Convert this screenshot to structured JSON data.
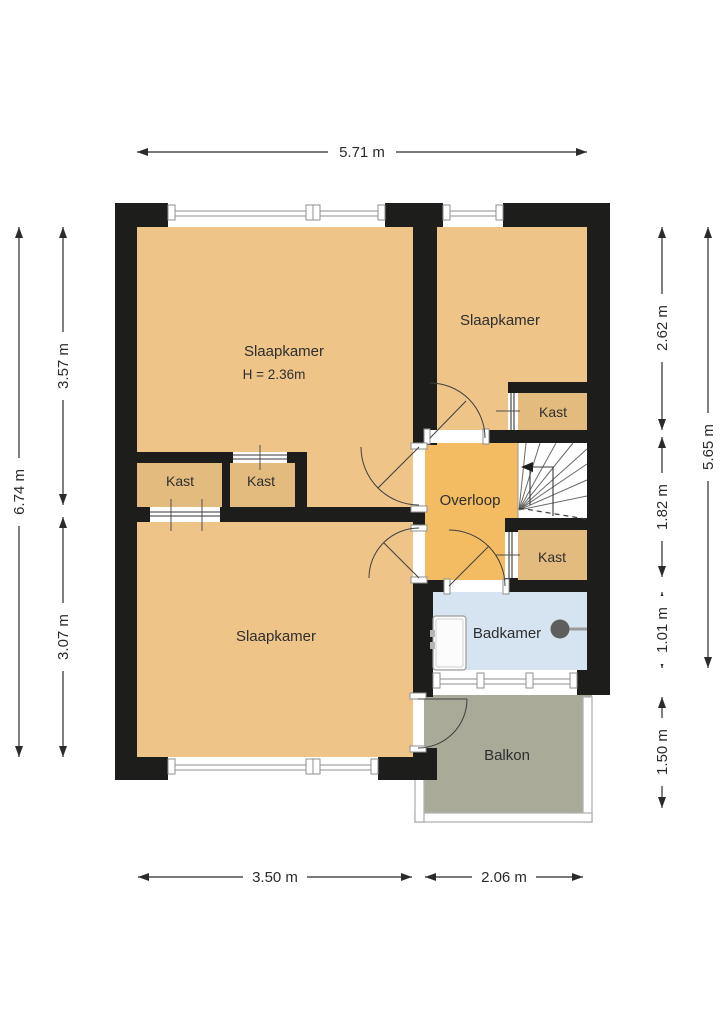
{
  "title": "Floor plan (verdieping)",
  "labels": {
    "slaapkamer_tl": "Slaapkamer",
    "slaapkamer_tl_note": "H = 2.36m",
    "slaapkamer_tr": "Slaapkamer",
    "slaapkamer_bottom": "Slaapkamer",
    "overloop": "Overloop",
    "badkamer": "Badkamer",
    "balkon": "Balkon",
    "kast_left": "Kast",
    "kast_middle": "Kast",
    "kast_top_right": "Kast",
    "kast_bottom_right": "Kast"
  },
  "dimensions": {
    "top_width": "5.71 m",
    "left_total": "6.74 m",
    "left_upper": "3.57 m",
    "left_lower": "3.07 m",
    "right_top": "2.62 m",
    "right_middle": "1.82 m",
    "right_bathroom": "1.01 m",
    "right_total": "5.65 m",
    "right_balcony": "1.50 m",
    "bottom_left": "3.50 m",
    "bottom_right": "2.06 m"
  },
  "colors": {
    "wall": "#1d1d1b",
    "room": "#eec488",
    "hallway": "#f4bc62",
    "closet": "#e4bb7e",
    "bathroom": "#d5e4f0",
    "balcony": "#a9aa98",
    "background": "#ffffff",
    "dimension": "#2b2b2b"
  }
}
